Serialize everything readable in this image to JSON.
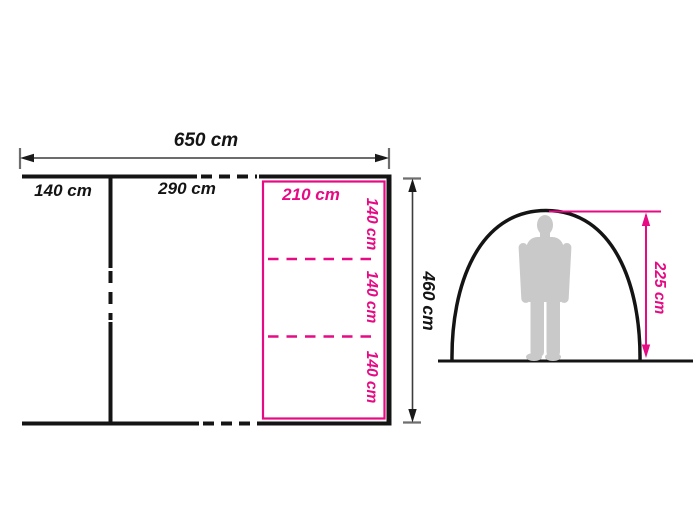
{
  "colors": {
    "accent_pink": "#e60a84",
    "line_black": "#141414",
    "dim_gray": "#6e6e6e",
    "silhouette_gray": "#c9c9c9",
    "background": "#ffffff"
  },
  "floor_plan": {
    "total_width_label": "650 cm",
    "left_section_label": "140 cm",
    "middle_section_label": "290 cm",
    "total_depth_label": "460 cm",
    "inner_tent": {
      "width_label": "210 cm",
      "segment_labels": [
        "140 cm",
        "140 cm",
        "140 cm"
      ]
    }
  },
  "side_elevation": {
    "peak_height_label": "225 cm"
  }
}
